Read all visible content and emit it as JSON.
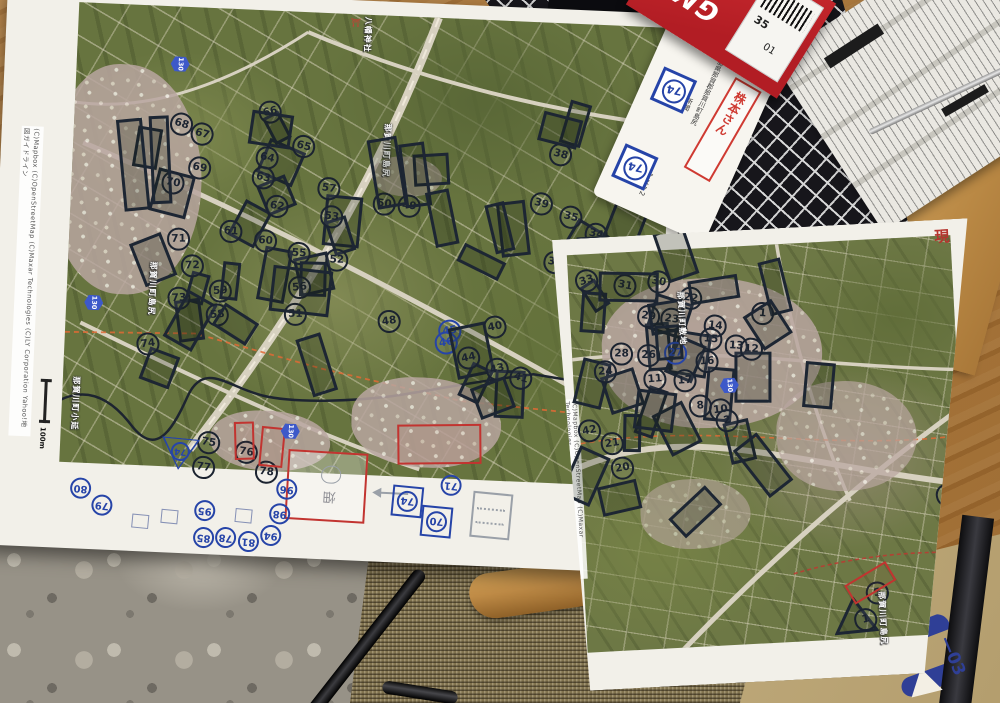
{
  "scene": {
    "corner_stamp": "現",
    "envelope_fragment": "—03"
  },
  "gmb": {
    "brand": "GMB",
    "label_line1": "35",
    "label_line2": "01"
  },
  "memo": {
    "pencil_note": "マップ",
    "address": "徳島県那賀郡那賀川町島尻",
    "tag_newspaper": "新聞",
    "tag_mask": "マスク2",
    "name_label": "株本さん",
    "squares": [
      "74",
      "74"
    ]
  },
  "sheet_a": {
    "copyright": "(C)Mapbox (C)OpenStreetMap (C)Maxar Technologies (C)LY Corporation Yahoo!地図ガイドライン",
    "scale_label": "100m",
    "field_note": "畑",
    "place_labels": [
      {
        "t": "八幡神社",
        "x": 356,
        "y": 16
      },
      {
        "t": "那賀川町島尻",
        "x": 380,
        "y": 122
      },
      {
        "t": "那賀川町島尻",
        "x": 152,
        "y": 270
      },
      {
        "t": "那賀川町小延",
        "x": 80,
        "y": 388
      }
    ],
    "route_shields": [
      {
        "n": "130",
        "x": 168,
        "y": 62
      },
      {
        "n": "130",
        "x": 92,
        "y": 304
      },
      {
        "n": "130",
        "x": 294,
        "y": 424
      }
    ],
    "markers": [
      {
        "n": "66",
        "x": 256,
        "y": 104,
        "p": 1
      },
      {
        "n": "68",
        "x": 168,
        "y": 120,
        "p": 1
      },
      {
        "n": "67",
        "x": 189,
        "y": 129
      },
      {
        "n": "65",
        "x": 291,
        "y": 137,
        "p": 1
      },
      {
        "n": "64",
        "x": 255,
        "y": 150
      },
      {
        "n": "63",
        "x": 252,
        "y": 170,
        "p": 1
      },
      {
        "n": "69",
        "x": 188,
        "y": 163,
        "p": 1
      },
      {
        "n": "70",
        "x": 162,
        "y": 179
      },
      {
        "n": "62",
        "x": 267,
        "y": 198,
        "p": 1
      },
      {
        "n": "57",
        "x": 318,
        "y": 178,
        "p": 1
      },
      {
        "n": "53",
        "x": 322,
        "y": 206,
        "p": 1
      },
      {
        "n": "50",
        "x": 374,
        "y": 191
      },
      {
        "n": "49",
        "x": 399,
        "y": 192,
        "p": 1
      },
      {
        "n": "61",
        "x": 222,
        "y": 225
      },
      {
        "n": "60",
        "x": 257,
        "y": 233,
        "p": 1
      },
      {
        "n": "55",
        "x": 291,
        "y": 244,
        "p": 1
      },
      {
        "n": "52",
        "x": 329,
        "y": 249
      },
      {
        "n": "51",
        "x": 290,
        "y": 305,
        "p": 1
      },
      {
        "n": "71",
        "x": 170,
        "y": 235,
        "p": 1
      },
      {
        "n": "72",
        "x": 185,
        "y": 261,
        "p": 1
      },
      {
        "n": "73",
        "x": 173,
        "y": 294,
        "p": 1
      },
      {
        "n": "59",
        "x": 214,
        "y": 285,
        "p": 1
      },
      {
        "n": "58",
        "x": 212,
        "y": 309,
        "p": 1
      },
      {
        "n": "56",
        "x": 293,
        "y": 278
      },
      {
        "n": "74",
        "x": 144,
        "y": 341,
        "p": 1
      },
      {
        "n": "48",
        "x": 384,
        "y": 308
      },
      {
        "n": "45",
        "x": 445,
        "y": 315,
        "ink": "blue"
      },
      {
        "n": "46",
        "x": 442,
        "y": 327,
        "ink": "blue"
      },
      {
        "n": "40",
        "x": 490,
        "y": 309,
        "p": 1
      },
      {
        "n": "44",
        "x": 465,
        "y": 341,
        "p": 1
      },
      {
        "n": "43",
        "x": 494,
        "y": 351,
        "p": 1
      },
      {
        "n": "41",
        "x": 518,
        "y": 359,
        "p": 1
      },
      {
        "n": "38",
        "x": 548,
        "y": 134,
        "p": 1
      },
      {
        "n": "39",
        "x": 531,
        "y": 184,
        "p": 1
      },
      {
        "n": "35",
        "x": 561,
        "y": 196,
        "p": 1
      },
      {
        "n": "34",
        "x": 587,
        "y": 212
      },
      {
        "n": "36",
        "x": 547,
        "y": 242
      },
      {
        "n": "32",
        "x": 595,
        "y": 234,
        "p": 1
      },
      {
        "n": "75",
        "x": 209,
        "y": 437
      },
      {
        "n": "76",
        "x": 247,
        "y": 445
      },
      {
        "n": "77",
        "x": 205,
        "y": 462
      },
      {
        "n": "78",
        "x": 268,
        "y": 464
      }
    ],
    "red_outlines": [
      {
        "x": 246,
        "y": 426,
        "w": 20,
        "h": 38,
        "r": -4
      },
      {
        "x": 272,
        "y": 430,
        "w": 24,
        "h": 40,
        "r": 3
      },
      {
        "x": 409,
        "y": 420,
        "w": 84,
        "h": 40,
        "r": -3
      }
    ],
    "margin_items": [
      {
        "type": "tri",
        "n": "74",
        "x": 210,
        "y": 478
      },
      {
        "type": "c",
        "n": "96",
        "x": 290,
        "y": 481
      },
      {
        "type": "c",
        "n": "98",
        "x": 284,
        "y": 506
      },
      {
        "type": "c",
        "n": "95",
        "x": 209,
        "y": 506
      },
      {
        "type": "c",
        "n": "85",
        "x": 209,
        "y": 533
      },
      {
        "type": "c",
        "n": "78",
        "x": 231,
        "y": 532
      },
      {
        "type": "c",
        "n": "81",
        "x": 254,
        "y": 535
      },
      {
        "type": "c",
        "n": "94",
        "x": 276,
        "y": 528
      },
      {
        "type": "c",
        "n": "80",
        "x": 84,
        "y": 489
      },
      {
        "type": "c",
        "n": "79",
        "x": 106,
        "y": 505
      },
      {
        "type": "c",
        "n": "71",
        "x": 454,
        "y": 470
      },
      {
        "type": "sq",
        "n": "74",
        "x": 406,
        "y": 483
      },
      {
        "type": "sq",
        "n": "70",
        "x": 436,
        "y": 502
      },
      {
        "type": "esq",
        "x": 176,
        "y": 517
      },
      {
        "type": "esq",
        "x": 147,
        "y": 523
      },
      {
        "type": "esq",
        "x": 250,
        "y": 513
      },
      {
        "type": "box",
        "x": 486,
        "y": 486
      }
    ]
  },
  "sheet_b": {
    "copyright": "(C)Mapbox (C)OpenStreetMap (C)Maxar Technologies",
    "place_labels": [
      {
        "t": "那賀川町敷地",
        "x": 120,
        "y": 58
      },
      {
        "t": "那賀川町島尻",
        "x": 305,
        "y": 368
      }
    ],
    "route_shields": [
      {
        "n": "130",
        "x": 162,
        "y": 145
      }
    ],
    "markers": [
      {
        "n": "33",
        "x": 21,
        "y": 31,
        "p": 1
      },
      {
        "n": "31",
        "x": 59,
        "y": 38,
        "p": 1
      },
      {
        "n": "30",
        "x": 93,
        "y": 36,
        "p": 1
      },
      {
        "n": "22",
        "x": 124,
        "y": 54,
        "p": 1
      },
      {
        "n": "29",
        "x": 81,
        "y": 70,
        "p": 1
      },
      {
        "n": "23",
        "x": 104,
        "y": 74
      },
      {
        "n": "14",
        "x": 147,
        "y": 83,
        "p": 1
      },
      {
        "n": "1",
        "x": 195,
        "y": 73,
        "p": 1
      },
      {
        "n": "15",
        "x": 142,
        "y": 96,
        "p": 1
      },
      {
        "n": "13",
        "x": 167,
        "y": 104,
        "p": 1
      },
      {
        "n": "12",
        "x": 182,
        "y": 108
      },
      {
        "n": "28",
        "x": 52,
        "y": 106,
        "p": 1
      },
      {
        "n": "26",
        "x": 79,
        "y": 109,
        "p": 1
      },
      {
        "n": "27",
        "x": 106,
        "y": 108,
        "ink": "blue"
      },
      {
        "n": "16",
        "x": 137,
        "y": 118,
        "p": 1
      },
      {
        "n": "24",
        "x": 35,
        "y": 123,
        "p": 1
      },
      {
        "n": "17",
        "x": 114,
        "y": 136,
        "p": 1
      },
      {
        "n": "11",
        "x": 84,
        "y": 133,
        "p": 1
      },
      {
        "n": "8",
        "x": 128,
        "y": 162,
        "p": 1
      },
      {
        "n": "10",
        "x": 148,
        "y": 167
      },
      {
        "n": "2",
        "x": 154,
        "y": 178,
        "p": 1
      },
      {
        "n": "21",
        "x": 38,
        "y": 195,
        "p": 1
      },
      {
        "n": "20",
        "x": 47,
        "y": 220,
        "p": 1
      },
      {
        "n": "42",
        "x": 16,
        "y": 181
      },
      {
        "n": "3",
        "x": 370,
        "y": 264,
        "p": 1
      },
      {
        "n": "5",
        "x": 295,
        "y": 358
      },
      {
        "n": "1",
        "x": 282,
        "y": 384
      }
    ],
    "red_outlines": [
      {
        "x": 276,
        "y": 348,
        "w": 48,
        "h": 22,
        "r": -28
      }
    ]
  }
}
